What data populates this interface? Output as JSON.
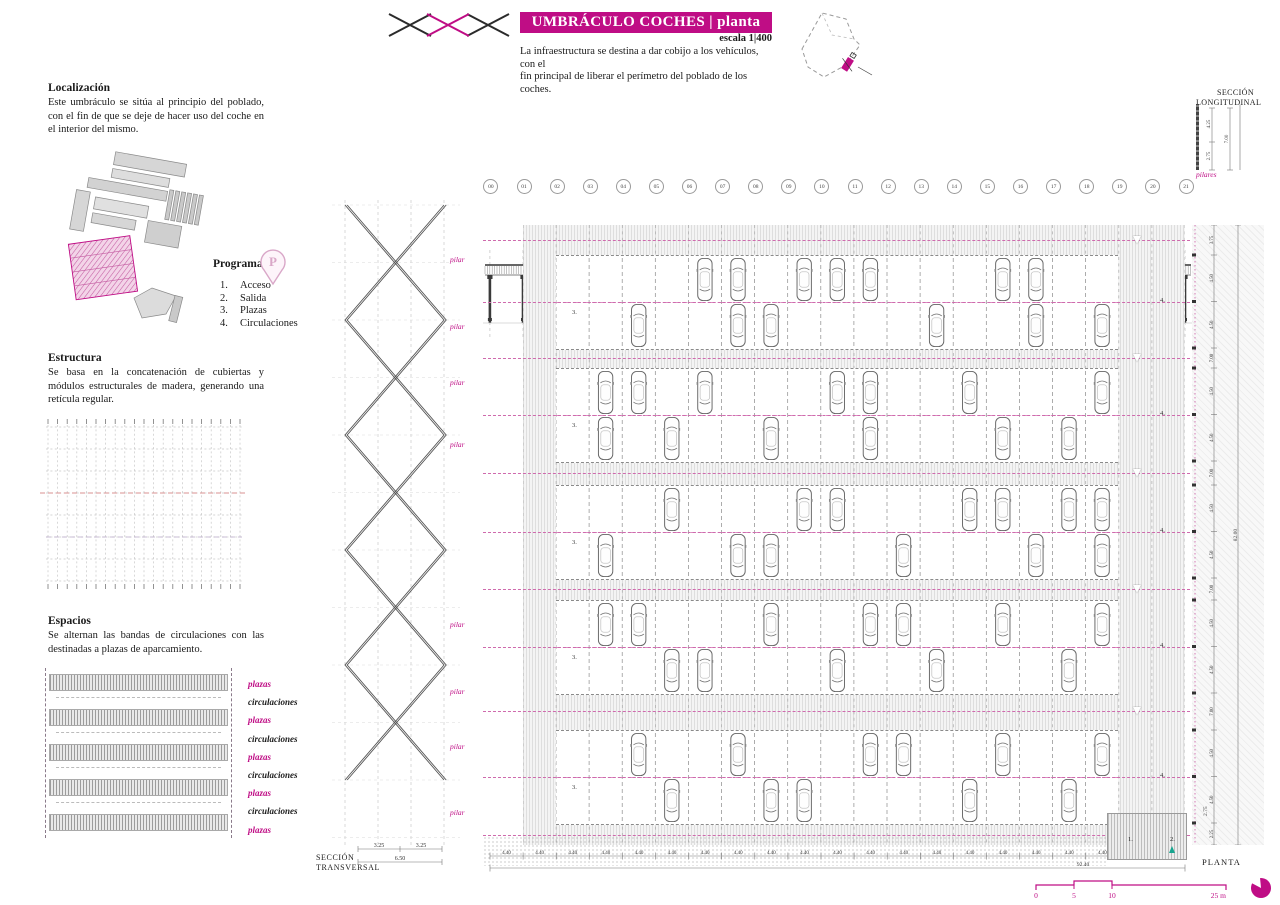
{
  "accent": "#BF0D85",
  "teal": "#17a58f",
  "header": {
    "title": "UMBRÁCULO COCHES | planta",
    "scale": "escala 1|400",
    "desc": {
      "l1": "La infraestructura se destina a dar cobijo a los vehículos, con el",
      "l2": "fin principal de liberar el perímetro del poblado de los coches."
    }
  },
  "localizacion": {
    "heading": "Localización",
    "body": "Este umbráculo se sitúa al principio del poblado, con el fin de que se deje de hacer uso del coche en el interior del mismo."
  },
  "programa": {
    "heading": "Programa",
    "icon": "parking-pin-icon",
    "items": [
      {
        "num": "1.",
        "label": "Acceso"
      },
      {
        "num": "2.",
        "label": "Salida"
      },
      {
        "num": "3.",
        "label": "Plazas"
      },
      {
        "num": "4.",
        "label": "Circulaciones"
      }
    ]
  },
  "estructura": {
    "heading": "Estructura",
    "body": "Se basa en la concatenación de cubiertas y módulos estructurales de madera, generando una retícula regular."
  },
  "espacios": {
    "heading": "Espacios",
    "body": "Se alternan las bandas de circulaciones con las destinadas a plazas de aparcamiento.",
    "labels": [
      "plazas",
      "circulaciones",
      "plazas",
      "circulaciones",
      "plazas",
      "circulaciones",
      "plazas",
      "circulaciones",
      "plazas"
    ]
  },
  "transversal": {
    "label_l1": "SECCIÓN",
    "label_l2": "TRANSVERSAL",
    "pilar": "pilar",
    "pilar_y": [
      55,
      122,
      178,
      240,
      420,
      487,
      542,
      608
    ],
    "dim_a": "3.25",
    "dim_b": "3.25",
    "dim_total": "6.50"
  },
  "longitudinal": {
    "label_l1": "SECCIÓN",
    "label_l2": "LONGITUDINAL",
    "pilares": "pilares",
    "dim_upper": "4.25",
    "dim_lower": "2.75",
    "dim_total": "7.00",
    "grid": [
      "00",
      "01",
      "02",
      "03",
      "04",
      "05",
      "06",
      "07",
      "08",
      "09",
      "10",
      "11",
      "12",
      "13",
      "14",
      "15",
      "16",
      "17",
      "18",
      "19",
      "20",
      "21"
    ]
  },
  "plan": {
    "label": "PLANTA",
    "stall_num": "3.",
    "circ_num": "4.",
    "access_num": "1.",
    "exit_num": "2.",
    "bay_dim": "4.40",
    "bottom_total": "92.40",
    "side_dim": "2.75",
    "right_total": "82.00",
    "right_dims": [
      "3.75",
      "4.50",
      "4.50",
      "7.00",
      "4.50",
      "4.50",
      "7.00",
      "4.50",
      "4.50",
      "7.00",
      "4.50",
      "4.50",
      "7.00",
      "4.50",
      "4.50",
      "2.25"
    ],
    "bands": [
      {
        "top": 30,
        "cars_top": [
          4,
          5,
          7,
          8,
          9,
          13,
          14
        ],
        "cars_bottom": [
          2,
          5,
          6,
          11,
          14,
          16
        ]
      },
      {
        "top": 143,
        "cars_top": [
          1,
          2,
          4,
          8,
          9,
          12,
          16
        ],
        "cars_bottom": [
          1,
          3,
          6,
          9,
          13,
          15
        ]
      },
      {
        "top": 260,
        "cars_top": [
          3,
          7,
          8,
          12,
          13,
          15,
          16
        ],
        "cars_bottom": [
          1,
          5,
          6,
          10,
          14,
          16
        ]
      },
      {
        "top": 375,
        "cars_top": [
          1,
          2,
          6,
          9,
          10,
          13,
          16
        ],
        "cars_bottom": [
          3,
          4,
          8,
          11,
          15
        ]
      },
      {
        "top": 505,
        "cars_top": [
          2,
          5,
          9,
          10,
          13,
          16
        ],
        "cars_bottom": [
          3,
          6,
          7,
          12,
          15
        ]
      }
    ],
    "gap_centers": [
      15,
      133,
      248,
      364,
      486,
      610
    ]
  },
  "scalebar": {
    "t0": "0",
    "t1": "5",
    "t2": "10",
    "t3": "25 m"
  }
}
